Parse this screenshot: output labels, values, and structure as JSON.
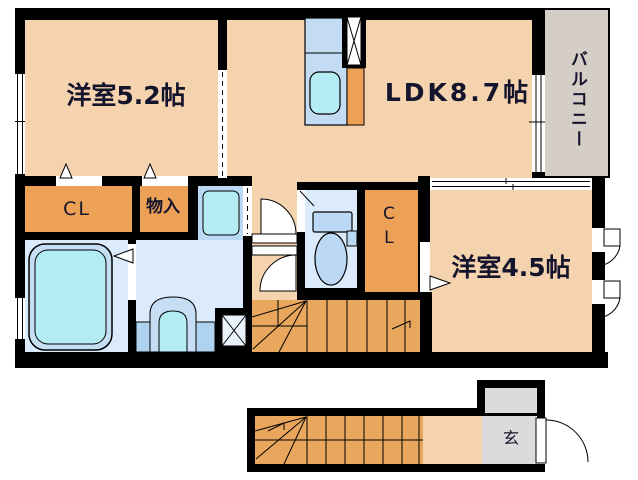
{
  "labels": {
    "room_5_2": "洋室5.2帖",
    "ldk": "LDK8.7帖",
    "balcony": "バルコニー",
    "closet_left": "CL",
    "storage": "物入",
    "closet_middle": "CL",
    "room_4_5": "洋室4.5帖",
    "entrance": "玄"
  },
  "colors": {
    "wall": "#000000",
    "room_peach": "#F5D3AE",
    "closet_orange": "#ECA156",
    "stairs_orange": "#E8A75C",
    "water_blue": "#DCEBFB",
    "fixture_blue": "#BBD9F5",
    "fixture_cyan": "#B3ECF3",
    "fixture_light": "#C6DEF4",
    "balcony_gray": "#D5CEC7",
    "entrance_gray": "#DBDBDB",
    "text": "#14142C"
  }
}
